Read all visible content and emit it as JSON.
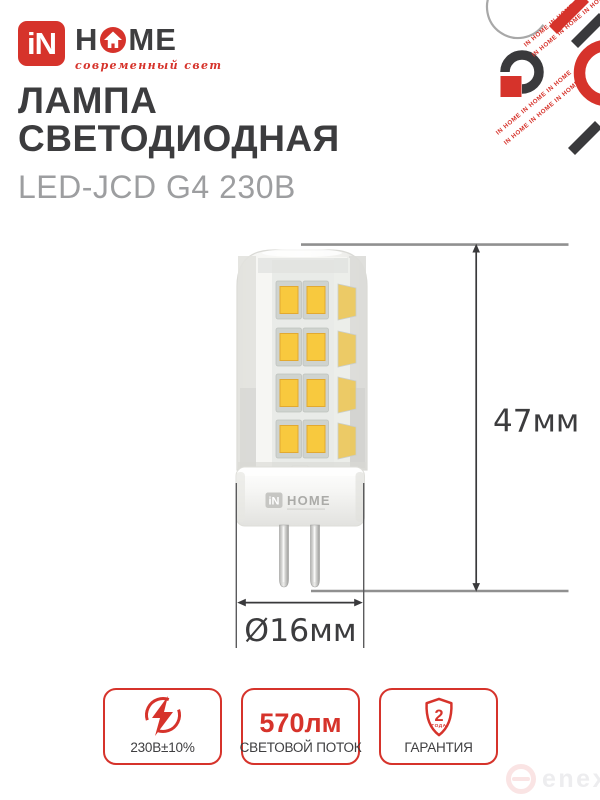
{
  "brand": {
    "square": "iN",
    "home_h": "H",
    "home_m": "M",
    "home_e": "E",
    "tagline": "современный свет"
  },
  "title": {
    "line1": "ЛАМПА",
    "line2": "СВЕТОДИОДНАЯ",
    "subtitle": "LED-JCD G4 230В"
  },
  "diagram": {
    "height_label": "47мм",
    "diameter_label": "Ø16мм",
    "base_brand_square": "iN",
    "base_brand_text": "HOME"
  },
  "badges": [
    {
      "icon": "voltage-lightning-icon",
      "label": "230В±10%"
    },
    {
      "value": "570лм",
      "label": "СВЕТОВОЙ ПОТОК"
    },
    {
      "icon": "warranty-shield-icon",
      "shield_value": "2",
      "shield_sub": "ГОДА",
      "label": "ГАРАНТИЯ"
    }
  ],
  "decor": {
    "diagonal_text": "IN HOME IN HOME IN HOME"
  },
  "watermark": {
    "text": "enex"
  },
  "colors": {
    "red": "#d6332b",
    "dark": "#3c3c3e",
    "gray": "#9d9ea0",
    "led_yellow": "#f8c93e"
  }
}
